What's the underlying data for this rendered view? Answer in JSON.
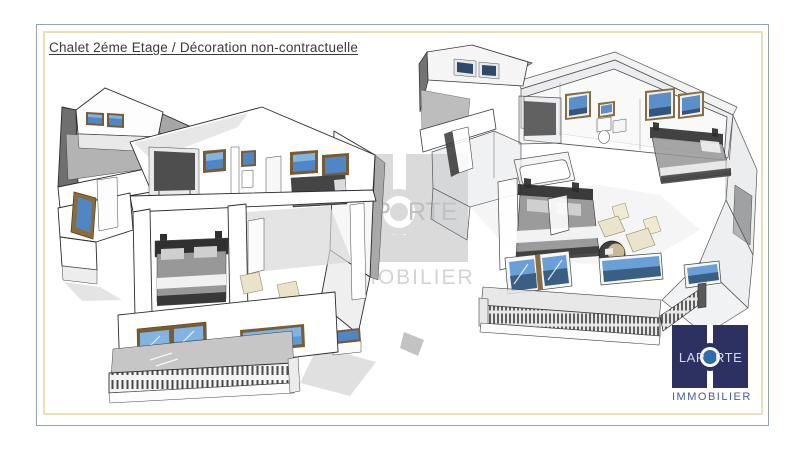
{
  "page": {
    "title": "Chalet 2éme Etage / Décoration non-contractuelle"
  },
  "watermark": {
    "left": "LAP",
    "right": "RTE",
    "subtitle": "IMMOBILIER"
  },
  "logo": {
    "left": "LAP",
    "right": "RTE",
    "subtitle": "IMMOBILIER"
  },
  "colors": {
    "border_outer": "#95a3b4",
    "border_inner": "#e9e0b4",
    "title_text": "#3a3a3a",
    "window_blue": "#5b9bd5",
    "window_blue_light": "#82b4e2",
    "window_blue_dark": "#33557e",
    "frame_brown": "#7a5c33",
    "roof_gray": "#a6a6a6",
    "dark_wall_gray": "#6f6f6f",
    "bed_dark": "#303030",
    "chair_beige": "#eae3c9",
    "watermark_gray": "#bcbcbc",
    "logo_navy": "#2c3162",
    "logo_circle_blue": "#2f6da8",
    "logo_subtitle_blue": "#4a57a5"
  }
}
